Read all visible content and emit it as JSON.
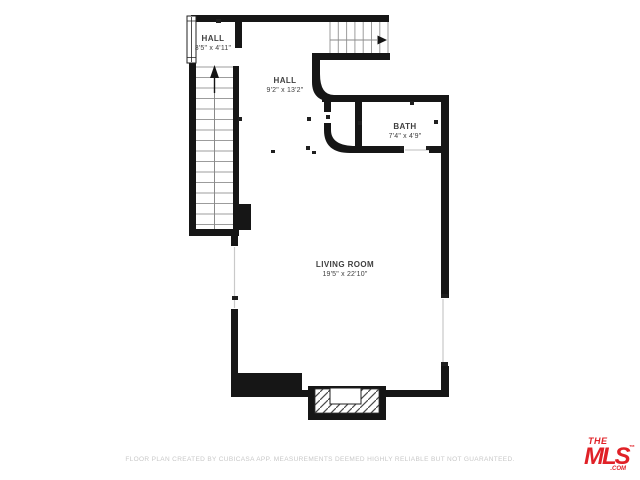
{
  "rooms": [
    {
      "id": "hall-small",
      "name": "HALL",
      "dims": "3'5\" x 4'11\""
    },
    {
      "id": "hall-main",
      "name": "HALL",
      "dims": "9'2\" x 13'2\""
    },
    {
      "id": "bath",
      "name": "BATH",
      "dims": "7'4\" x 4'9\""
    },
    {
      "id": "living-room",
      "name": "LIVING ROOM",
      "dims": "19'5\" x 22'10\""
    }
  ],
  "footer": {
    "disclaimer": "FLOOR PLAN CREATED BY CUBICASA APP. MEASUREMENTS DEEMED HIGHLY RELIABLE BUT NOT GUARANTEED."
  },
  "logo": {
    "the": "THE",
    "name": "MLS",
    "tm": "™",
    "domain": ".COM"
  },
  "colors": {
    "wall": "#161616",
    "stair": "#9c9c9c",
    "label": "#3f3f3f",
    "disclaimer": "#c8c8c8",
    "brand_red": "#e02127"
  }
}
